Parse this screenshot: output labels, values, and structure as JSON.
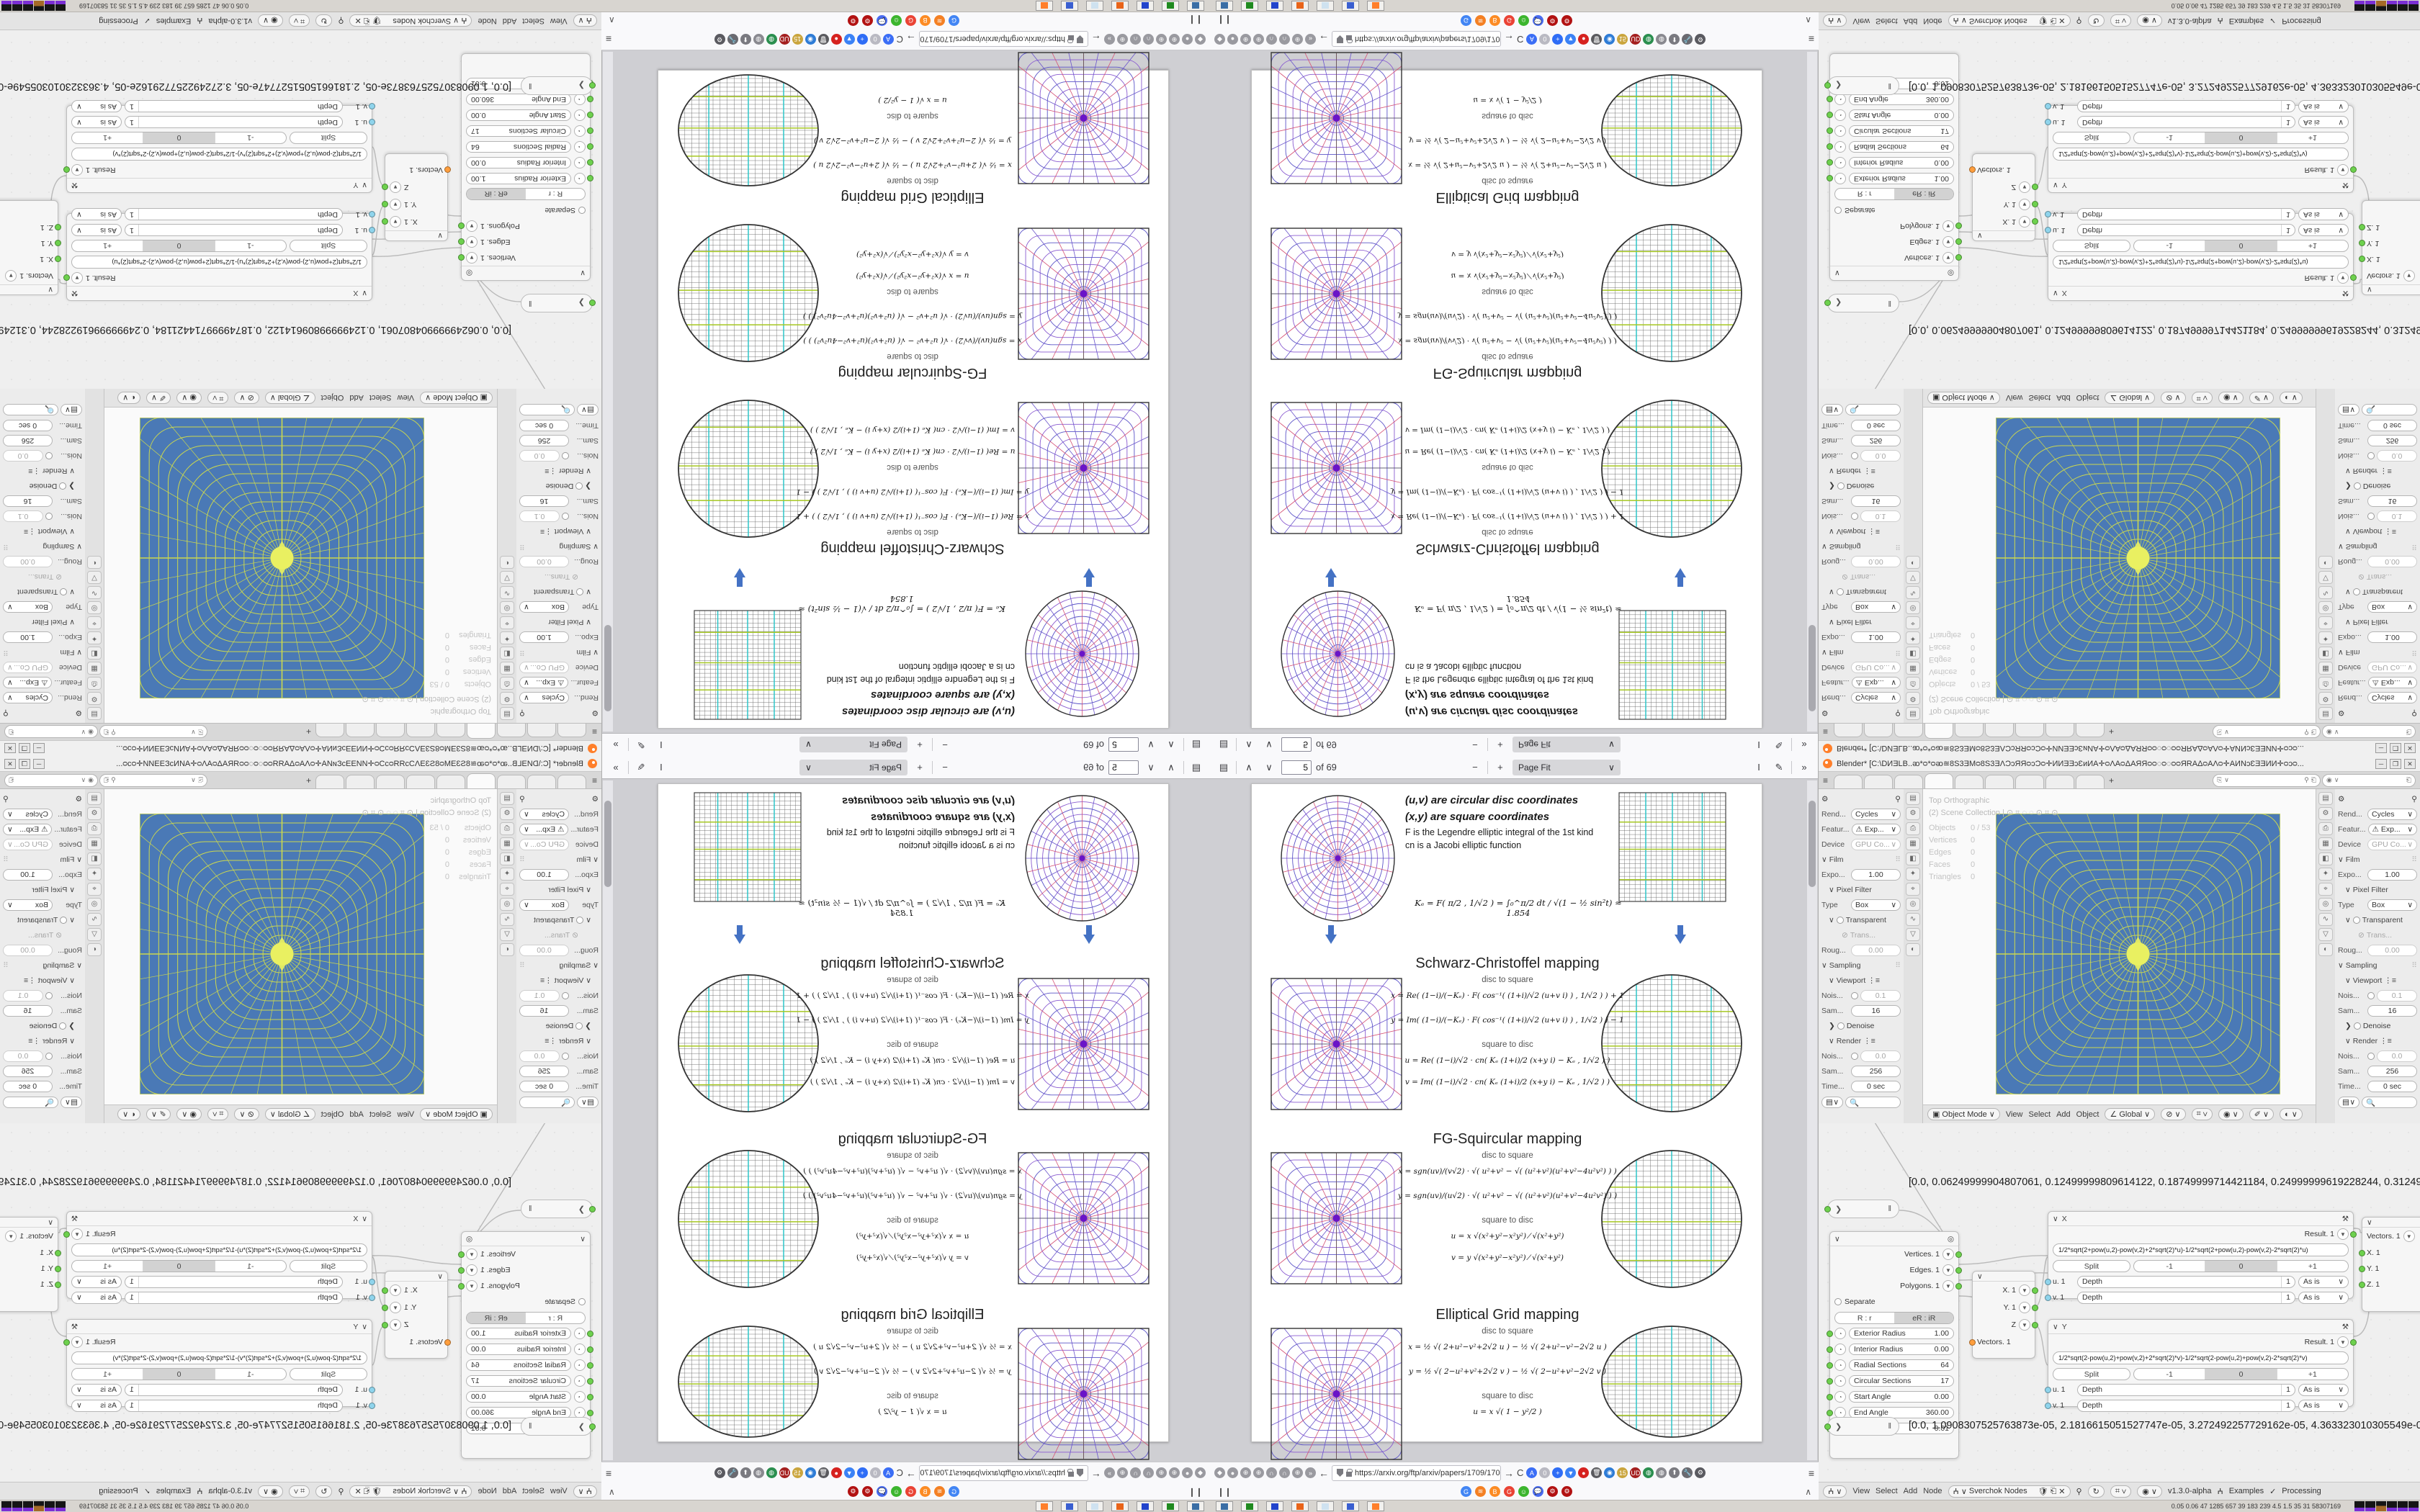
{
  "pdf": {
    "toolbar": {
      "page_value": "5",
      "page_total": "of 69",
      "zoom_label": "Page Fit",
      "minus": "−",
      "plus": "+",
      "up": "∧",
      "down": "∨",
      "sidebar_icon": "▤",
      "text_tool": "I",
      "draw_tool": "✎",
      "more": "»"
    },
    "page": {
      "legend": [
        "(u,v)  are circular disc coordinates",
        "(x,y)  are square coordinates"
      ],
      "legend2": [
        "F is the Legendre elliptic integral of the 1st kind",
        "cn is a Jacobi elliptic function"
      ],
      "ke": "Kₑ = F( π/2 , 1/√2 ) = ∫₀^π/2  dt / √(1 − ½ sin²t)  ≈ 1.854",
      "d2s_label": "disc to square",
      "s2d_label": "square to disc",
      "sections": [
        {
          "title": "Schwarz-Christoffel mapping",
          "f1": "x = Re( (1−i)/(−Kₑ) · F( cos⁻¹( (1+i)/√2 (u+v i) ) , 1/√2 ) ) + 1",
          "f2": "y = Im( (1−i)/(−Kₑ) · F( cos⁻¹( (1+i)/√2 (u+v i) ) , 1/√2 ) ) − 1",
          "f3": "u = Re( (1−i)/√2 · cn( Kₑ (1+i)/2 (x+y i) − Kₑ , 1/√2 ) )",
          "f4": "v = Im( (1−i)/√2 · cn( Kₑ (1+i)/2 (x+y i) − Kₑ , 1/√2 ) )"
        },
        {
          "title": "FG-Squircular mapping",
          "f1": "x = sgn(uv)/(v√2) · √( u²+v² − √( (u²+v²)(u²+v²−4u²v²) ) )",
          "f2": "y = sgn(uv)/(u√2) · √( u²+v² − √( (u²+v²)(u²+v²−4u²v²) ) )",
          "f3": "u = x √(x²+y²−x²y²) ⁄ √(x²+y²)",
          "f4": "v = y √(x²+y²−x²y²) ⁄ √(x²+y²)"
        },
        {
          "title": "Elliptical Grid mapping",
          "f1": "x = ½ √( 2+u²−v²+2√2 u )  −  ½ √( 2+u²−v²−2√2 u )",
          "f2": "y = ½ √( 2−u²+v²+2√2 v )  −  ½ √( 2−u²+v²−2√2 v )",
          "f3": "u = x √( 1 − y²/2 )",
          "f4": "v = y √( 1 − x²/2 )"
        }
      ]
    },
    "navbar": {
      "url": "https://arxiv.org/ftp/arxiv/papers/1709/1709",
      "back": "←",
      "fwd": "→",
      "reload": "C",
      "menu": "≡",
      "left_icons": [
        "◆",
        "●",
        "⊕",
        "⊕",
        "∩",
        "∩",
        "⊕",
        "»"
      ],
      "right_icons": [
        {
          "g": "A",
          "c": "#3b6ef6"
        },
        {
          "g": "0",
          "c": "#b9b9c2"
        },
        {
          "g": "+",
          "c": "#2f6df6"
        },
        {
          "g": "▼",
          "c": "#3b82f6"
        },
        {
          "g": "●",
          "c": "#d6221f"
        },
        {
          "g": "🗑",
          "c": "#5a5a5e"
        },
        {
          "g": "◉",
          "c": "#2e7cd6"
        },
        {
          "g": "15",
          "c": "#caa53d"
        },
        {
          "g": "UD",
          "c": "#a41f1f"
        },
        {
          "g": "◍",
          "c": "#2b8f4f"
        },
        {
          "g": "◍",
          "c": "#8a8a90"
        },
        {
          "g": "⬆",
          "c": "#7a7a80"
        },
        {
          "g": "🔧",
          "c": "#6a6a70"
        },
        {
          "g": "⚙",
          "c": "#5a5a60"
        }
      ]
    },
    "bookmarks": {
      "left_glyph": "❙❙",
      "collapse": "∧",
      "icons": [
        {
          "g": "G",
          "c": "#4285f4"
        },
        {
          "g": "≋",
          "c": "#f48024"
        },
        {
          "g": "B",
          "c": "#fc8b24"
        },
        {
          "g": "G",
          "c": "#ea4335"
        },
        {
          "g": "☺",
          "c": "#3cb52e"
        },
        {
          "g": "💬",
          "c": "#4a6cf0"
        },
        {
          "g": "⚙",
          "c": "#b21212"
        },
        {
          "g": "⚙",
          "c": "#b21212"
        }
      ]
    }
  },
  "blender": {
    "title": "Blender* [C:\\DИƎLB..ᴔ*ᴑ*ᴑᴔ≊8S3ƎMᴑ8S3ƎΛƆᴐЯЯᴑᴐƆᴑ✛ИИƎƎᴐƐᴎИA✛ᴑΛAᴑΔAЯЯᴑᴑ◌ᴑ◌ᴑᴑЯRAΔᴑAΛᴑ✛AИNᴐƐƎƎИИ✛ᴑᴐᴑ...",
    "win_min": "─",
    "win_max": "❒",
    "win_close": "✕",
    "tabs_menu": "≡",
    "tabs_plus": "+",
    "props": {
      "renderer_label": "Rend...",
      "renderer": "Cycles",
      "feature_label": "Featur...",
      "feature": "⚠ Exp...",
      "device_label": "Device",
      "device": "GPU Co...",
      "film": "Film",
      "exposure_label": "Expo...",
      "exposure": "1.00",
      "pixel_filter": "Pixel Filter",
      "type_label": "Type",
      "type": "Box",
      "transparent": "Transparent",
      "trans_glass": "Trans...",
      "rough_label": "Roug...",
      "rough": "0.00",
      "sampling": "Sampling",
      "viewport": "Viewport",
      "noise_v_label": "Nois...",
      "noise_v": "0.1",
      "samples_v_label": "Sam...",
      "samples_v": "16",
      "denoise": "Denoise",
      "render": "Render",
      "noise_r_label": "Nois...",
      "noise_r": "0.0",
      "samples_r_label": "Sam...",
      "samples_r": "256",
      "time_label": "Time...",
      "time": "0 sec",
      "tab_icons": [
        "▤",
        "⚙",
        "⎙",
        "▦",
        "◧",
        "✦",
        "⌖",
        "◎",
        "∿",
        "▽",
        "◐"
      ]
    },
    "viewport": {
      "overlay1": "Top Orthographic",
      "overlay2": "(2) Scene Collection  |  ⊙ ⌗ ◌ ◌ ⊙ ⌗ ⊙",
      "stats": [
        {
          "k": "Objects",
          "v": "0 / 53"
        },
        {
          "k": "Vertices",
          "v": "0"
        },
        {
          "k": "Edges",
          "v": "0"
        },
        {
          "k": "Faces",
          "v": "0"
        },
        {
          "k": "Triangles",
          "v": "0"
        }
      ],
      "mode": "Object Mode",
      "menus": [
        "View",
        "Select",
        "Add",
        "Object"
      ],
      "orientation": "Global"
    },
    "nodes": {
      "readout1": "[0.0, 0.06249999904807061, 0.12499999809614122, 0.18749999714421184, 0.24999999619228244, 0.31249999524035305, 0.374",
      "readout2": "[0.0, 1.0908307525763873e-05, 2.1816615051527747e-05, 3.272492257729162e-05, 4.363323010305549e-05, 5.454153762881936",
      "circle": {
        "outputs": [
          {
            "n": "Vertices. 1",
            "s": "o"
          },
          {
            "n": "Edges. 1",
            "s": "g"
          },
          {
            "n": "Polygons. 1",
            "s": "g"
          }
        ],
        "separate": "Separate",
        "seg": [
          "R : r",
          "eR : iR"
        ],
        "params": [
          {
            "l": "Exterior Radius",
            "v": "1.00"
          },
          {
            "l": "Interior Radius",
            "v": "0.00"
          },
          {
            "l": "Radial Sections",
            "v": "64"
          },
          {
            "l": "Circular Sections",
            "v": "17"
          },
          {
            "l": "Start Angle",
            "v": "0.00"
          },
          {
            "l": "End Angle",
            "v": "360.00"
          },
          {
            "l": "Phase",
            "v": "0.01"
          }
        ]
      },
      "xnode": {
        "title": "X",
        "result": "Result. 1",
        "formula": "1/2*sqrt(2+pow(u,2)-pow(v,2)+2*sqrt(2)*u)-1/2*sqrt(2+pow(u,2)-pow(v,2)-2*sqrt(2)*u)",
        "seg": [
          "Split",
          "-1",
          "0",
          "+1"
        ],
        "rows": [
          {
            "sock": "u. 1"
          },
          {
            "sock": "v. 1"
          }
        ],
        "depth_label": "Depth",
        "depth": "1",
        "asis": "As is"
      },
      "ynode": {
        "title": "Y",
        "result": "Result. 1",
        "formula": "1/2*sqrt(2-pow(u,2)+pow(v,2)+2*sqrt(2)*v)-1/2*sqrt(2-pow(u,2)+pow(v,2)-2*sqrt(2)*v)"
      },
      "vecin": {
        "rows": [
          "X. 1",
          "Y. 1",
          "Z"
        ],
        "out": "Vectors. 1"
      },
      "vecout": {
        "top": "Vectors. 1",
        "rows": [
          "X. 1",
          "Y. 1",
          "Z. 1"
        ]
      }
    },
    "sv_header": {
      "menus": [
        "View",
        "Select",
        "Add",
        "Node"
      ],
      "tree": "Sverchok Nodes",
      "version": "v1.3.0-alpha",
      "examples": "Examples",
      "processing": "Processing",
      "check": "✓"
    }
  },
  "taskbar": {
    "sysmon": "0.05 0.06   47   1285 657   39   183  239   4.5   1.5   35   31   58307169",
    "apps": [
      {
        "c": "#3a6ea5"
      },
      {
        "c": "#1f8a1f"
      },
      {
        "c": "#2244cc"
      },
      {
        "c": "#e8641a"
      },
      {
        "c": "#cfe2f0"
      },
      {
        "c": "#3a5fd0"
      },
      {
        "c": "#ff7f2a"
      }
    ]
  },
  "figures": {
    "polar": {
      "ring1": "#5b54c8",
      "ring2": "#8a5bd0",
      "spoke1": "#d44e72",
      "spoke2": "#6a54cc",
      "outline": "#333333",
      "center": "#6a14c8"
    },
    "grid": {
      "line": "#6a6a6a",
      "cyan": "#2fc6c9",
      "green": "#a6c822",
      "outline": "#444444"
    },
    "arrow": "#4472c4",
    "viewport": {
      "bg": "#4a79b6",
      "line": "#ccd84e",
      "blob": "#e9f062"
    }
  }
}
